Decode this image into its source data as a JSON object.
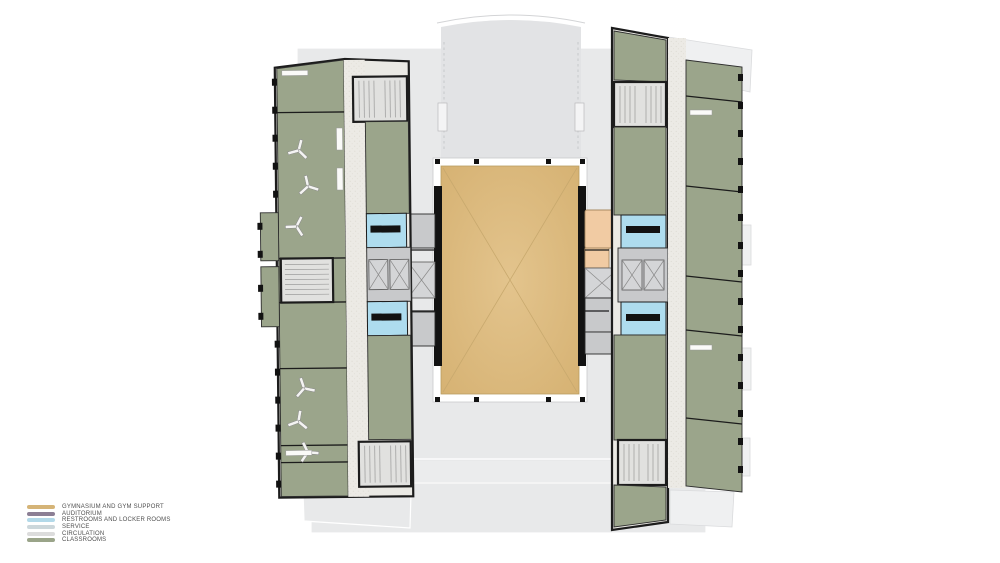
{
  "legend": {
    "items": [
      {
        "label": "GYMNASIUM AND GYM SUPPORT",
        "color": "#d5b477"
      },
      {
        "label": "AUDITORIUM",
        "color": "#8c7f95"
      },
      {
        "label": "RESTROOMS AND LOCKER ROOMS",
        "color": "#b3d9e9"
      },
      {
        "label": "SERVICE",
        "color": "#ccd7db"
      },
      {
        "label": "CIRCULATION",
        "color": "#dcdcdc"
      },
      {
        "label": "CLASSROOMS",
        "color": "#9aa489"
      }
    ]
  },
  "palette": {
    "classrooms": "#9ba58b",
    "gymnasium": "#debb80",
    "gym_support": "#f1cba3",
    "restrooms_locker": "#aedcee",
    "service": "#c8c9cb",
    "circulation": "#eceae5",
    "site_background": "#e8e9ea",
    "walls": "#1c1c1c"
  }
}
